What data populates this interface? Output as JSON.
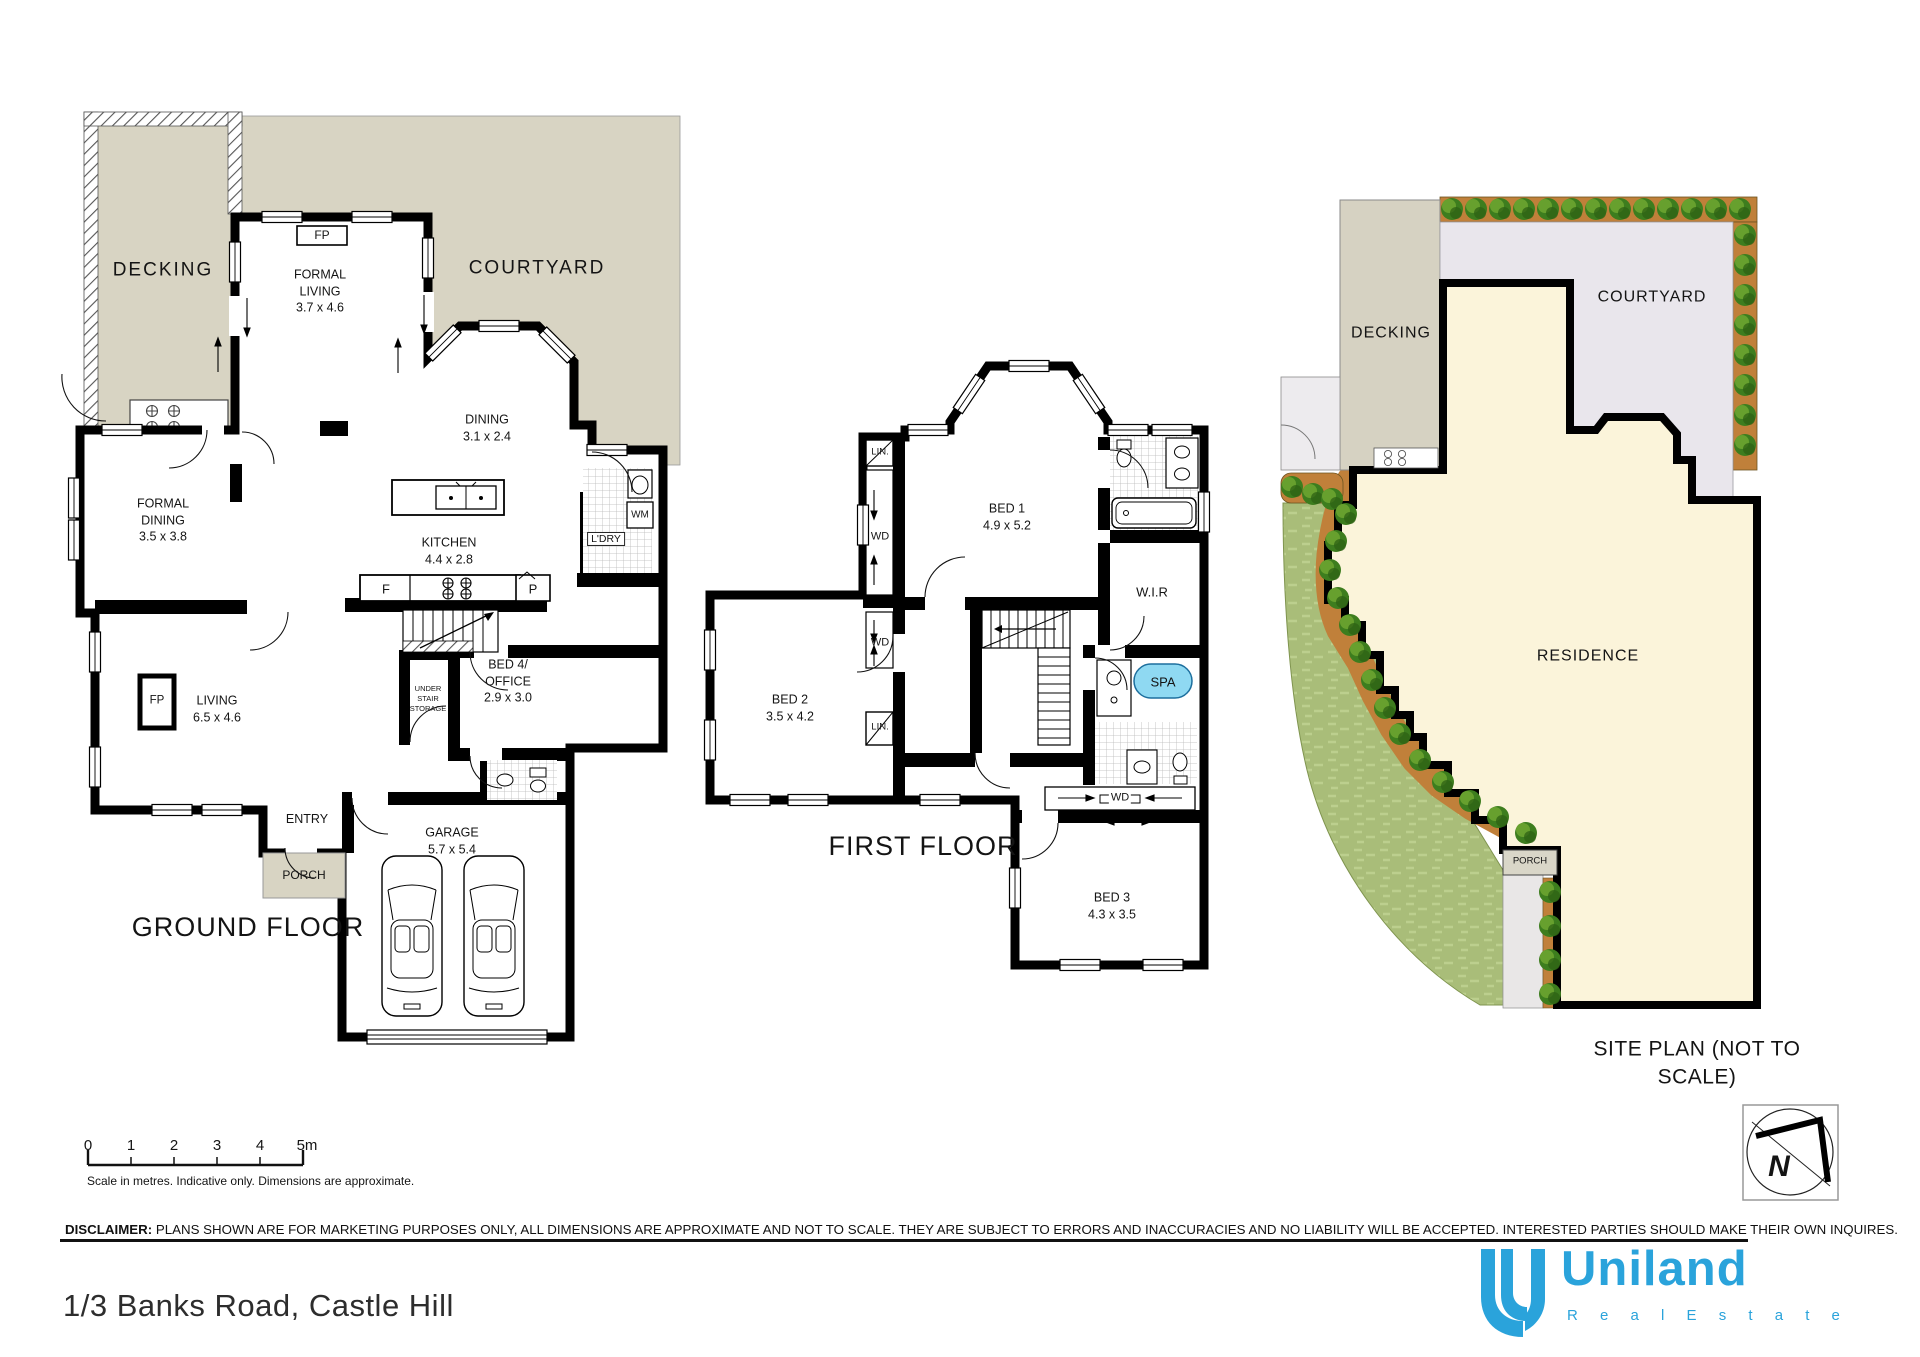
{
  "document": {
    "address": "1/3 Banks Road, Castle Hill"
  },
  "ground_floor": {
    "title": "GROUND FLOOR",
    "decking": "DECKING",
    "courtyard": "COURTYARD",
    "fireplace_formal": "FP",
    "fireplace_living": "FP",
    "formal_living": "FORMAL\nLIVING\n3.7 x 4.6",
    "dining": "DINING\n3.1 x 2.4",
    "formal_dining": "FORMAL\nDINING\n3.5 x 3.8",
    "kitchen": "KITCHEN\n4.4 x 2.8",
    "living": "LIVING\n6.5 x 4.6",
    "bed4": "BED 4/\nOFFICE\n2.9 x 3.0",
    "garage": "GARAGE\n5.7 x 5.4",
    "under_stair": "UNDER\nSTAIR\nSTORAGE",
    "laundry": "L'DRY",
    "wm": "WM",
    "fridge": "F",
    "pantry": "P",
    "entry": "ENTRY",
    "porch": "PORCH"
  },
  "first_floor": {
    "title": "FIRST FLOOR",
    "bed1": "BED 1\n4.9 x 5.2",
    "bed2": "BED 2\n3.5 x 4.2",
    "bed3": "BED 3\n4.3 x 3.5",
    "wir": "W.I.R",
    "spa": "SPA",
    "lin_top": "LIN.",
    "lin_mid": "LIN.",
    "wd_top": "WD",
    "wd_mid": "WD",
    "wd_bed3": "WD"
  },
  "site_plan": {
    "title": "SITE PLAN (NOT TO SCALE)",
    "decking": "DECKING",
    "courtyard": "COURTYARD",
    "residence": "RESIDENCE",
    "porch": "PORCH"
  },
  "scale_bar": {
    "ticks": [
      "0",
      "1",
      "2",
      "3",
      "4",
      "5m"
    ],
    "caption": "Scale in metres. Indicative only. Dimensions are approximate."
  },
  "disclaimer": {
    "label": "DISCLAIMER:",
    "text": " PLANS SHOWN ARE FOR MARKETING PURPOSES ONLY, ALL DIMENSIONS ARE APPROXIMATE AND NOT TO SCALE. THEY ARE SUBJECT TO ERRORS AND INACCURACIES AND NO LIABILITY WILL BE ACCEPTED. INTERESTED PARTIES SHOULD MAKE THEIR OWN INQUIRES."
  },
  "branding": {
    "name": "Uniland",
    "tagline": "R e a l   E s t a t e"
  },
  "compass": {
    "letter": "N"
  },
  "colors": {
    "beige": "#d8d4c3",
    "courtyard_site": "#e9e6ec",
    "residence": "#fbf4da",
    "grass": "#a9bd79",
    "garden": "#c0803a",
    "spa": "#8fd9f2",
    "brand": "#2aa3db"
  }
}
